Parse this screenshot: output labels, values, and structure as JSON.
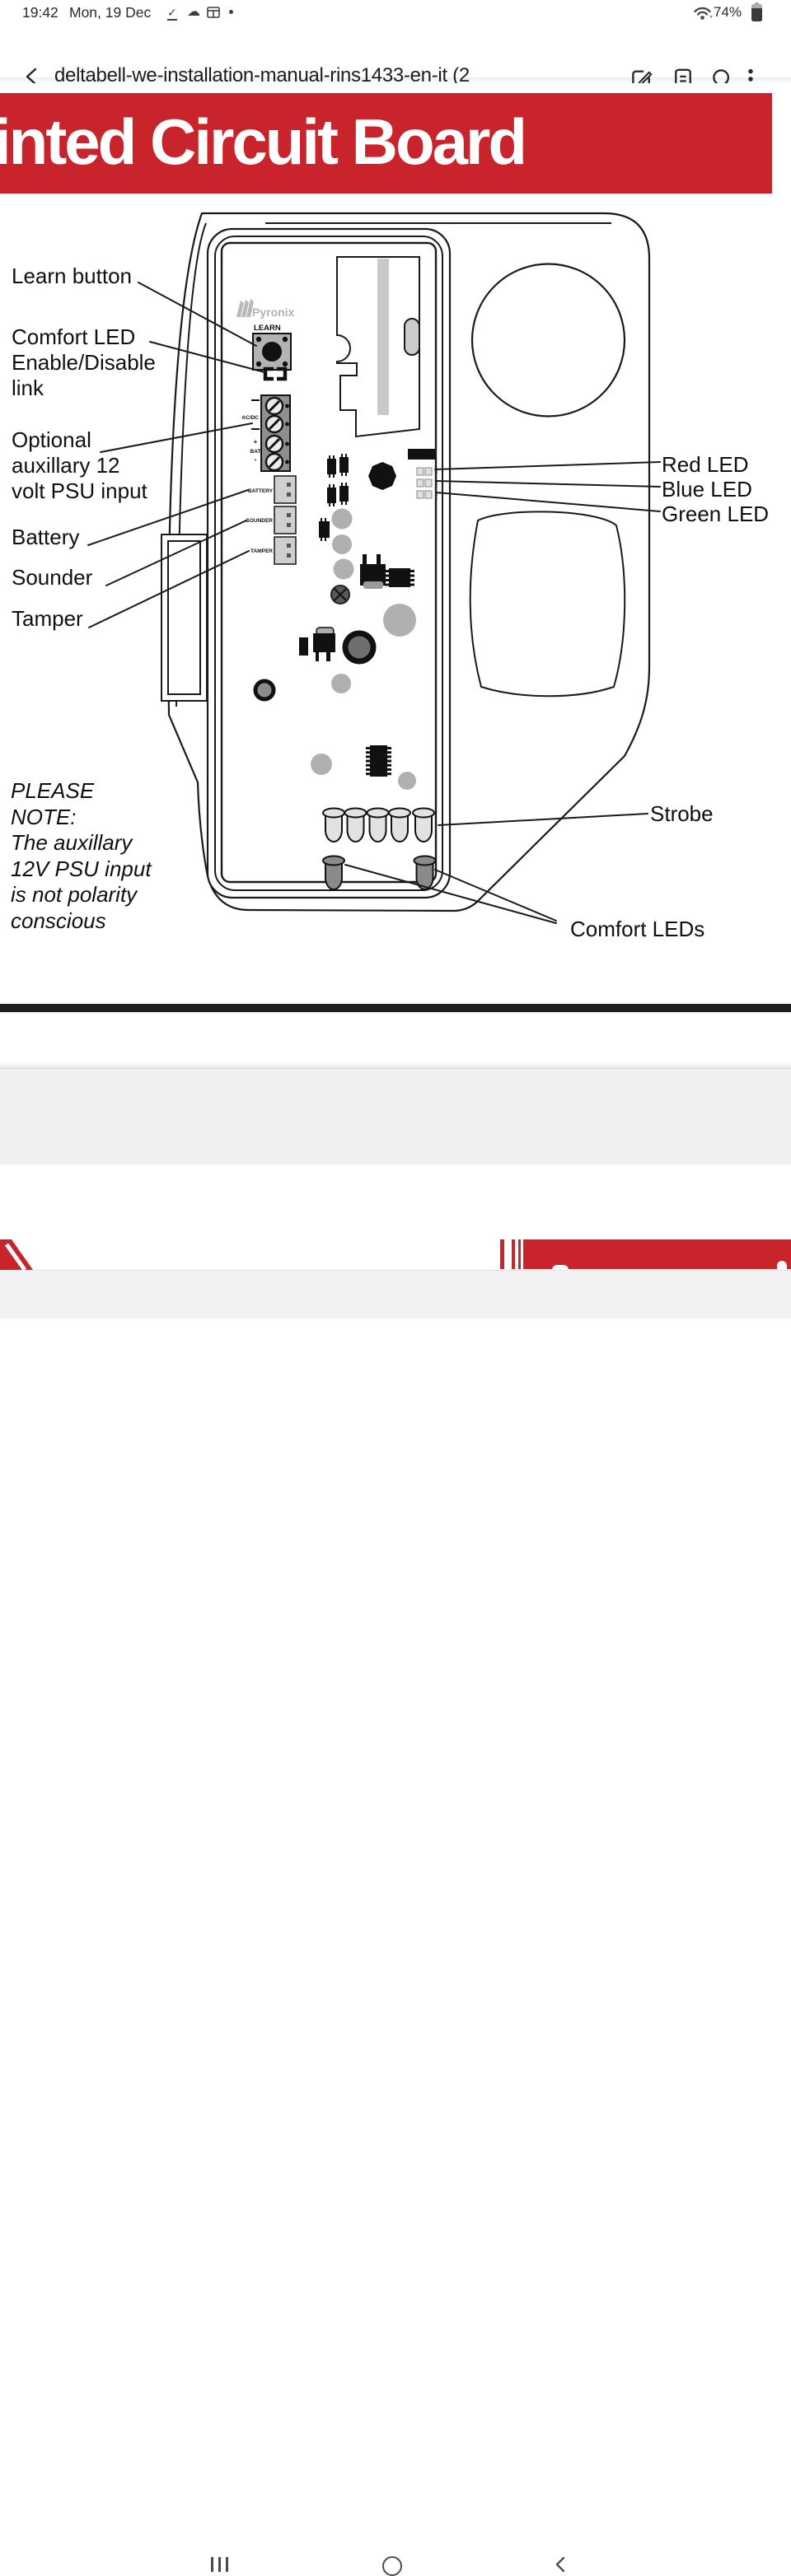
{
  "status_bar": {
    "time": "19:42",
    "date": "Mon, 19 Dec",
    "battery_percent": "74%"
  },
  "app_bar": {
    "title": "deltabell-we-installation-manual-rins1433-en-it (2"
  },
  "document": {
    "banner_title": "inted Circuit Board"
  },
  "diagram": {
    "callouts": {
      "learn": "Learn button",
      "comfort_link": [
        "Comfort LED",
        "Enable/Disable",
        "link"
      ],
      "psu": [
        "Optional",
        "auxillary 12",
        "volt PSU input"
      ],
      "battery": "Battery",
      "sounder": "Sounder",
      "tamper": "Tamper",
      "red_led": "Red LED",
      "blue_led": "Blue LED",
      "green_led": "Green LED",
      "strobe": "Strobe",
      "comfort_leds": "Comfort LEDs"
    },
    "note": [
      "PLEASE",
      "NOTE:",
      "The auxillary",
      "12V PSU input",
      "is not polarity",
      "conscious"
    ],
    "board": {
      "brand": "Pyronix",
      "learn_button": "LEARN",
      "acdc": "AC/DC",
      "bat_plus": "+",
      "bat": "BAT",
      "bat_minus": "-",
      "battery_conn": "BATTERY",
      "sounder_conn": "SOUNDER",
      "tamper_conn": "TAMPER",
      "led_labels": "LED 1  LED 2  LED 3"
    }
  },
  "colors": {
    "red": "#c9232b"
  }
}
